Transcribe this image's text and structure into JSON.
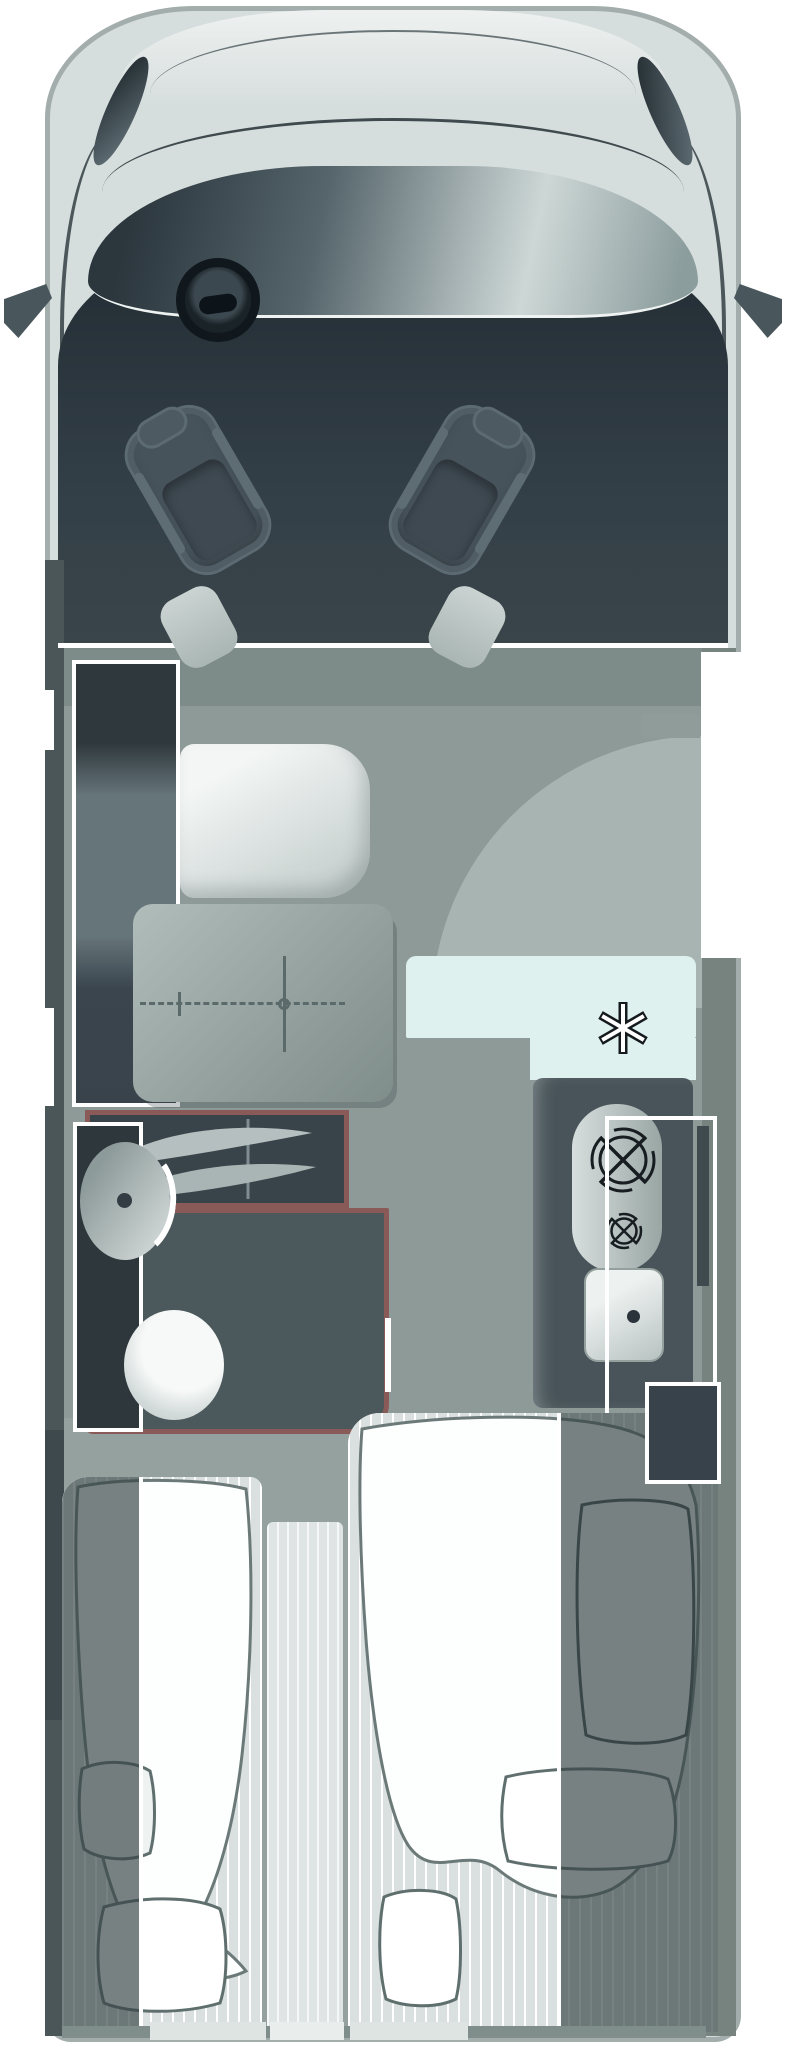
{
  "meta": {
    "title": "Motorhome floor plan, top-down view",
    "diagram_type": "vehicle-floor-plan"
  },
  "palette": {
    "background": "#ffffff",
    "body_shell": "#d6dedd",
    "cab_interior": "#2a343b",
    "living_floor": "#8d9a98",
    "rear_floor": "#95a19f",
    "washroom_wall_accent": "#8a5a58",
    "fridge_fill": "#def1ee",
    "furniture_outline": "#ffffff",
    "mattress_stripe": "#d9e0df"
  },
  "icons": {
    "snowflake_icon": "✱",
    "burner_icon": "circle-with-cross gas burner",
    "sink_drain_icon": "dot",
    "steering_wheel_icon": "ring with hub",
    "shower_screen_icon": "two leaf blades with hinge line",
    "table_mount_icon": "dashed cross with center ring"
  },
  "areas": [
    {
      "id": "cab",
      "label": "Cab with steering wheel and two swivel seats"
    },
    {
      "id": "sideboard",
      "label": "Sideboard cabinet (white outline)"
    },
    {
      "id": "dinette",
      "label": "Bench seat and pedestal table"
    },
    {
      "id": "entrance",
      "label": "Entry door with quarter-circle swing arc"
    },
    {
      "id": "washroom",
      "label": "Washroom: basin, toilet, shower screen (maroon walls)"
    },
    {
      "id": "kitchen",
      "label": "Kitchen block: two burners and sink"
    },
    {
      "id": "fridge",
      "label": "Refrigerator with snowflake mark"
    },
    {
      "id": "bedroom",
      "label": "Twin single beds with duvets, pillows and center step"
    },
    {
      "id": "rear_wardrobe",
      "label": "Rear wardrobe (white outline)"
    }
  ],
  "counts": {
    "seats": 2,
    "burners": 2,
    "beds": 2,
    "pillows_visible": 5
  }
}
